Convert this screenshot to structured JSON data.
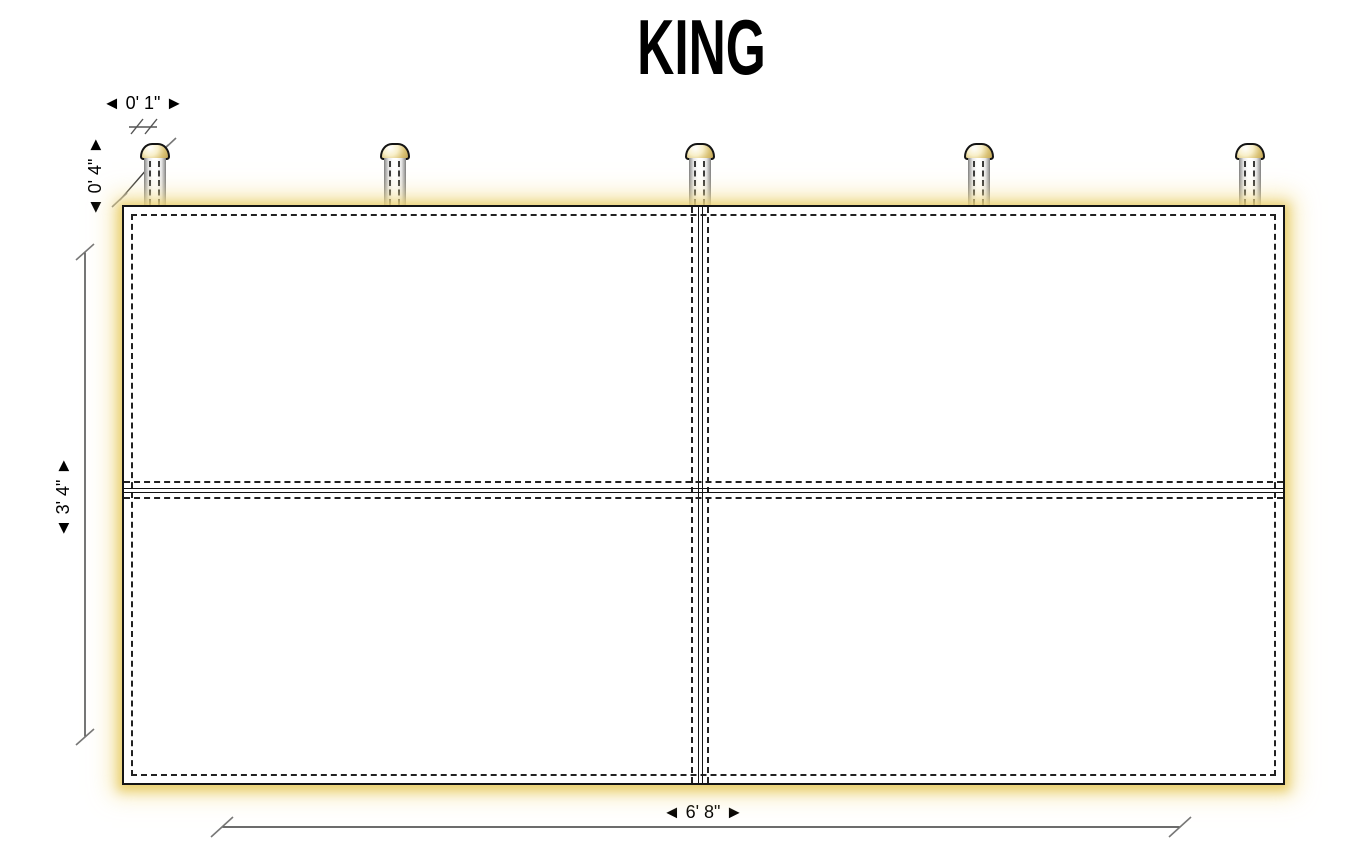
{
  "title": "KING",
  "colors": {
    "glow": "#eed88c",
    "cap-fill": "#d9c174",
    "outline": "#141414",
    "stitch": "#222222",
    "dim-line": "#3c3c3c",
    "tick": "#777777"
  },
  "dimensions": {
    "post_diameter": "◄ 0' 1\" ►",
    "post_height": "◄ 0' 4\" ►",
    "headboard_height": "◄ 3' 4\" ►",
    "headboard_width": "◄ 6' 8\" ►"
  },
  "posts": {
    "count": 5
  }
}
